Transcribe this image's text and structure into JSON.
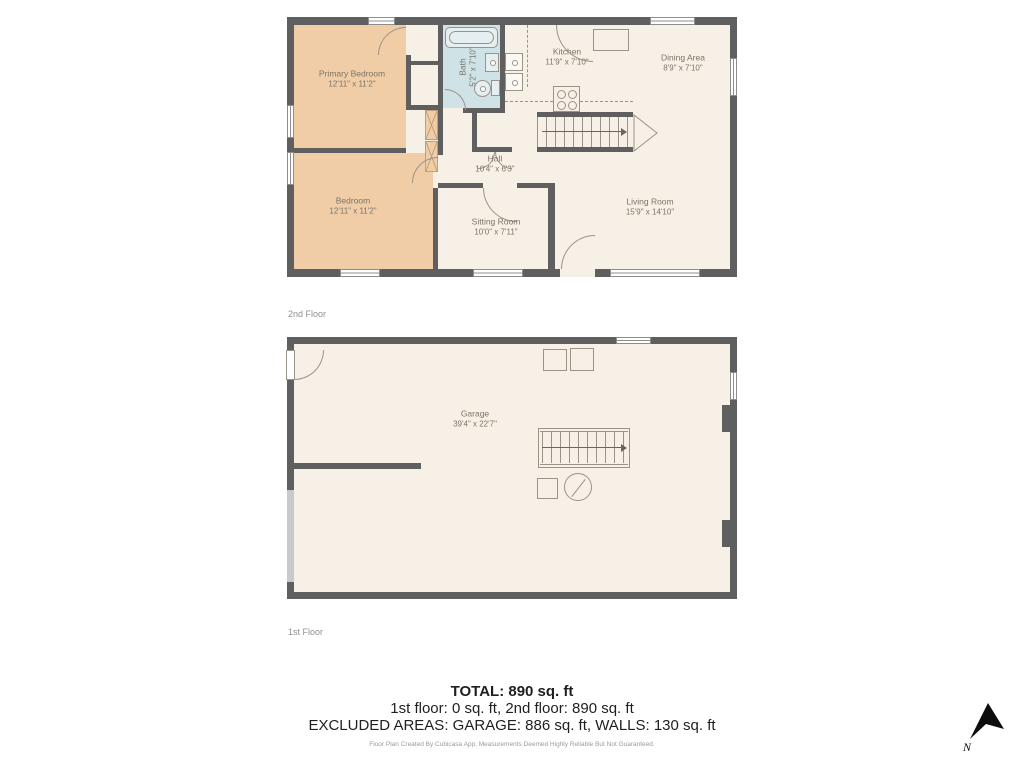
{
  "floors": {
    "second": "2nd Floor",
    "first": "1st Floor"
  },
  "rooms": {
    "primary_bedroom": {
      "name": "Primary Bedroom",
      "dims": "12'11\" x 11'2\""
    },
    "bath": {
      "name": "Bath",
      "dims": "5'2\" x 7'10\""
    },
    "kitchen": {
      "name": "Kitchen",
      "dims": "11'9\" x 7'10\""
    },
    "dining": {
      "name": "Dining Area",
      "dims": "8'9\" x 7'10\""
    },
    "hall": {
      "name": "Hall",
      "dims": "10'4\" x 6'3\""
    },
    "bedroom": {
      "name": "Bedroom",
      "dims": "12'11\" x 11'2\""
    },
    "sitting": {
      "name": "Sitting Room",
      "dims": "10'0\" x 7'11\""
    },
    "living": {
      "name": "Living Room",
      "dims": "15'9\" x 14'10\""
    },
    "garage": {
      "name": "Garage",
      "dims": "39'4\" x 22'7\""
    }
  },
  "summary": {
    "total": "TOTAL: 890 sq. ft",
    "floors_line": "1st floor: 0 sq. ft, 2nd floor: 890 sq. ft",
    "excluded_line": "EXCLUDED AREAS: GARAGE: 886 sq. ft, WALLS: 130 sq. ft",
    "disclaimer": "Floor Plan Created By Cubicasa App. Measurements Deemed Highly Reliable But Not Guaranteed."
  },
  "compass": {
    "label": "N"
  },
  "colors": {
    "wall": "#5f5f5f",
    "floor_fill": "#f7f0e6",
    "bedroom_fill": "#f0cda6",
    "bath_fill": "#cfe2e6",
    "fixture_line": "#9a9388",
    "label_text": "#7b7468"
  }
}
